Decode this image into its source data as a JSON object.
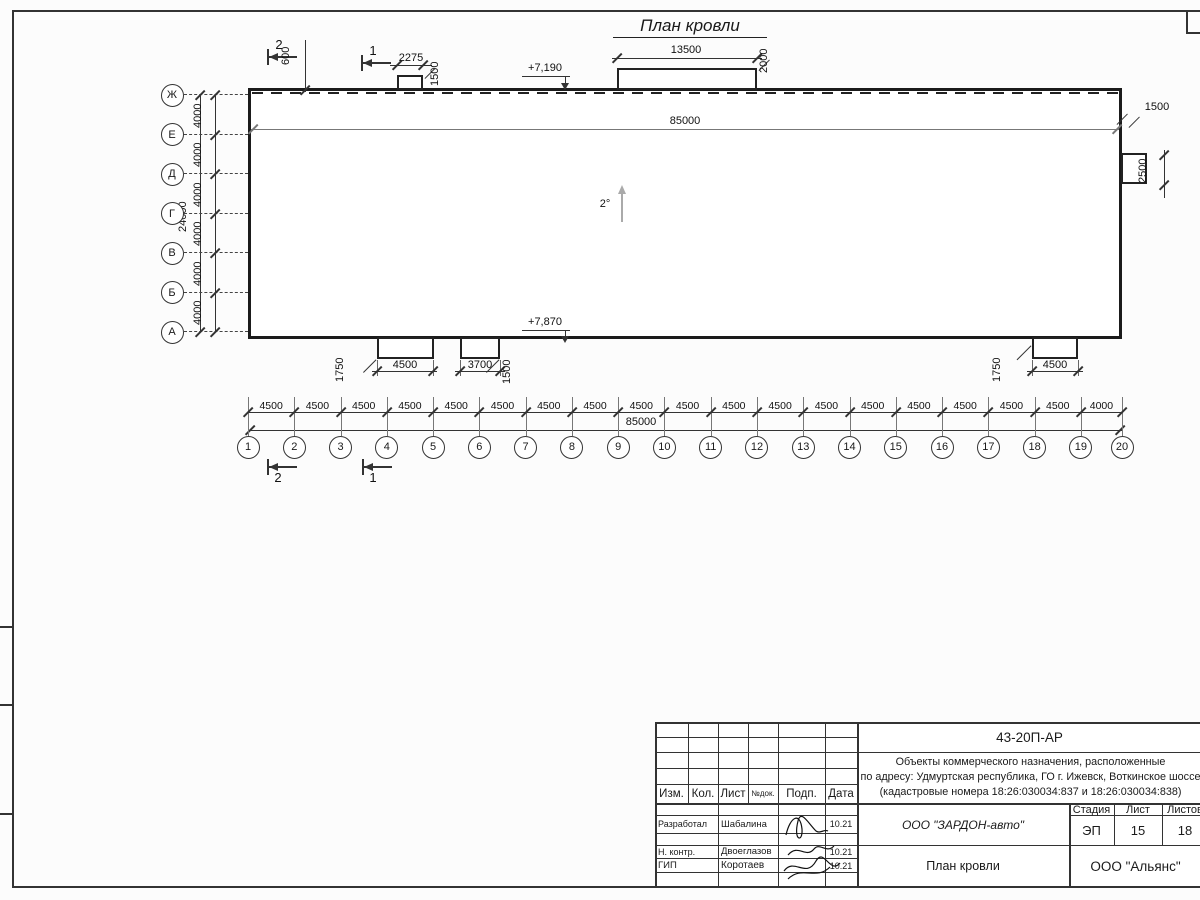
{
  "drawing": {
    "title": "План кровли",
    "slope_label": "2°",
    "section_marks": {
      "s1": "1",
      "s2": "2"
    }
  },
  "grid": {
    "row_labels": [
      "Ж",
      "Е",
      "Д",
      "Г",
      "В",
      "Б",
      "А"
    ],
    "row_segment_label": "4000",
    "row_total_label": "24000",
    "col_labels": [
      "1",
      "2",
      "3",
      "4",
      "5",
      "6",
      "7",
      "8",
      "9",
      "10",
      "11",
      "12",
      "13",
      "14",
      "15",
      "16",
      "17",
      "18",
      "19",
      "20"
    ],
    "col_segment_labels": [
      "4500",
      "4500",
      "4500",
      "4500",
      "4500",
      "4500",
      "4500",
      "4500",
      "4500",
      "4500",
      "4500",
      "4500",
      "4500",
      "4500",
      "4500",
      "4500",
      "4500",
      "4500",
      "4000"
    ],
    "col_total_label": "85000"
  },
  "dims": {
    "top": {
      "parapet_offset": "600",
      "canopy_small_width": "2275",
      "canopy_small_depth": "1500",
      "roof_level": "+7,190",
      "canopy_large_width": "13500",
      "canopy_large_depth": "2000",
      "overall_length": "85000"
    },
    "right": {
      "ledge_width": "1500",
      "ledge_height": "2500"
    },
    "bottom": {
      "roof_level": "+7,870",
      "left_canopy_depth": "1750",
      "left_canopy_width": "4500",
      "mid_canopy_width": "3700",
      "mid_canopy_depth": "1500",
      "right_canopy_depth": "1750",
      "right_canopy_width": "4500"
    }
  },
  "titleblock": {
    "doc_number": "43-20П-АР",
    "project_line1": "Объекты коммерческого назначения, расположенные",
    "project_line2": "по адресу: Удмуртская республика, ГО г. Ижевск, Воткинское шоссе",
    "project_line3": "(кадастровые номера 18:26:030034:837 и 18:26:030034:838)",
    "columns": {
      "izm": "Изм.",
      "kol": "Кол.",
      "list": "Лист",
      "ndok": "№док.",
      "podp": "Подп.",
      "data": "Дата"
    },
    "signatures": [
      {
        "role": "Разработал",
        "name": "Шабалина",
        "date": "10.21"
      },
      {
        "role": "Н. контр.",
        "name": "Двоеглазов",
        "date": "10.21"
      },
      {
        "role": "ГИП",
        "name": "Коротаев",
        "date": "10.21"
      }
    ],
    "client": "ООО \"ЗАРДОН-авто\"",
    "stage_label": "Стадия",
    "sheet_label": "Лист",
    "sheets_label": "Листов",
    "stage": "ЭП",
    "sheet_no": "15",
    "sheets_total": "18",
    "sheet_title": "План кровли",
    "contractor": "ООО \"Альянс\""
  }
}
